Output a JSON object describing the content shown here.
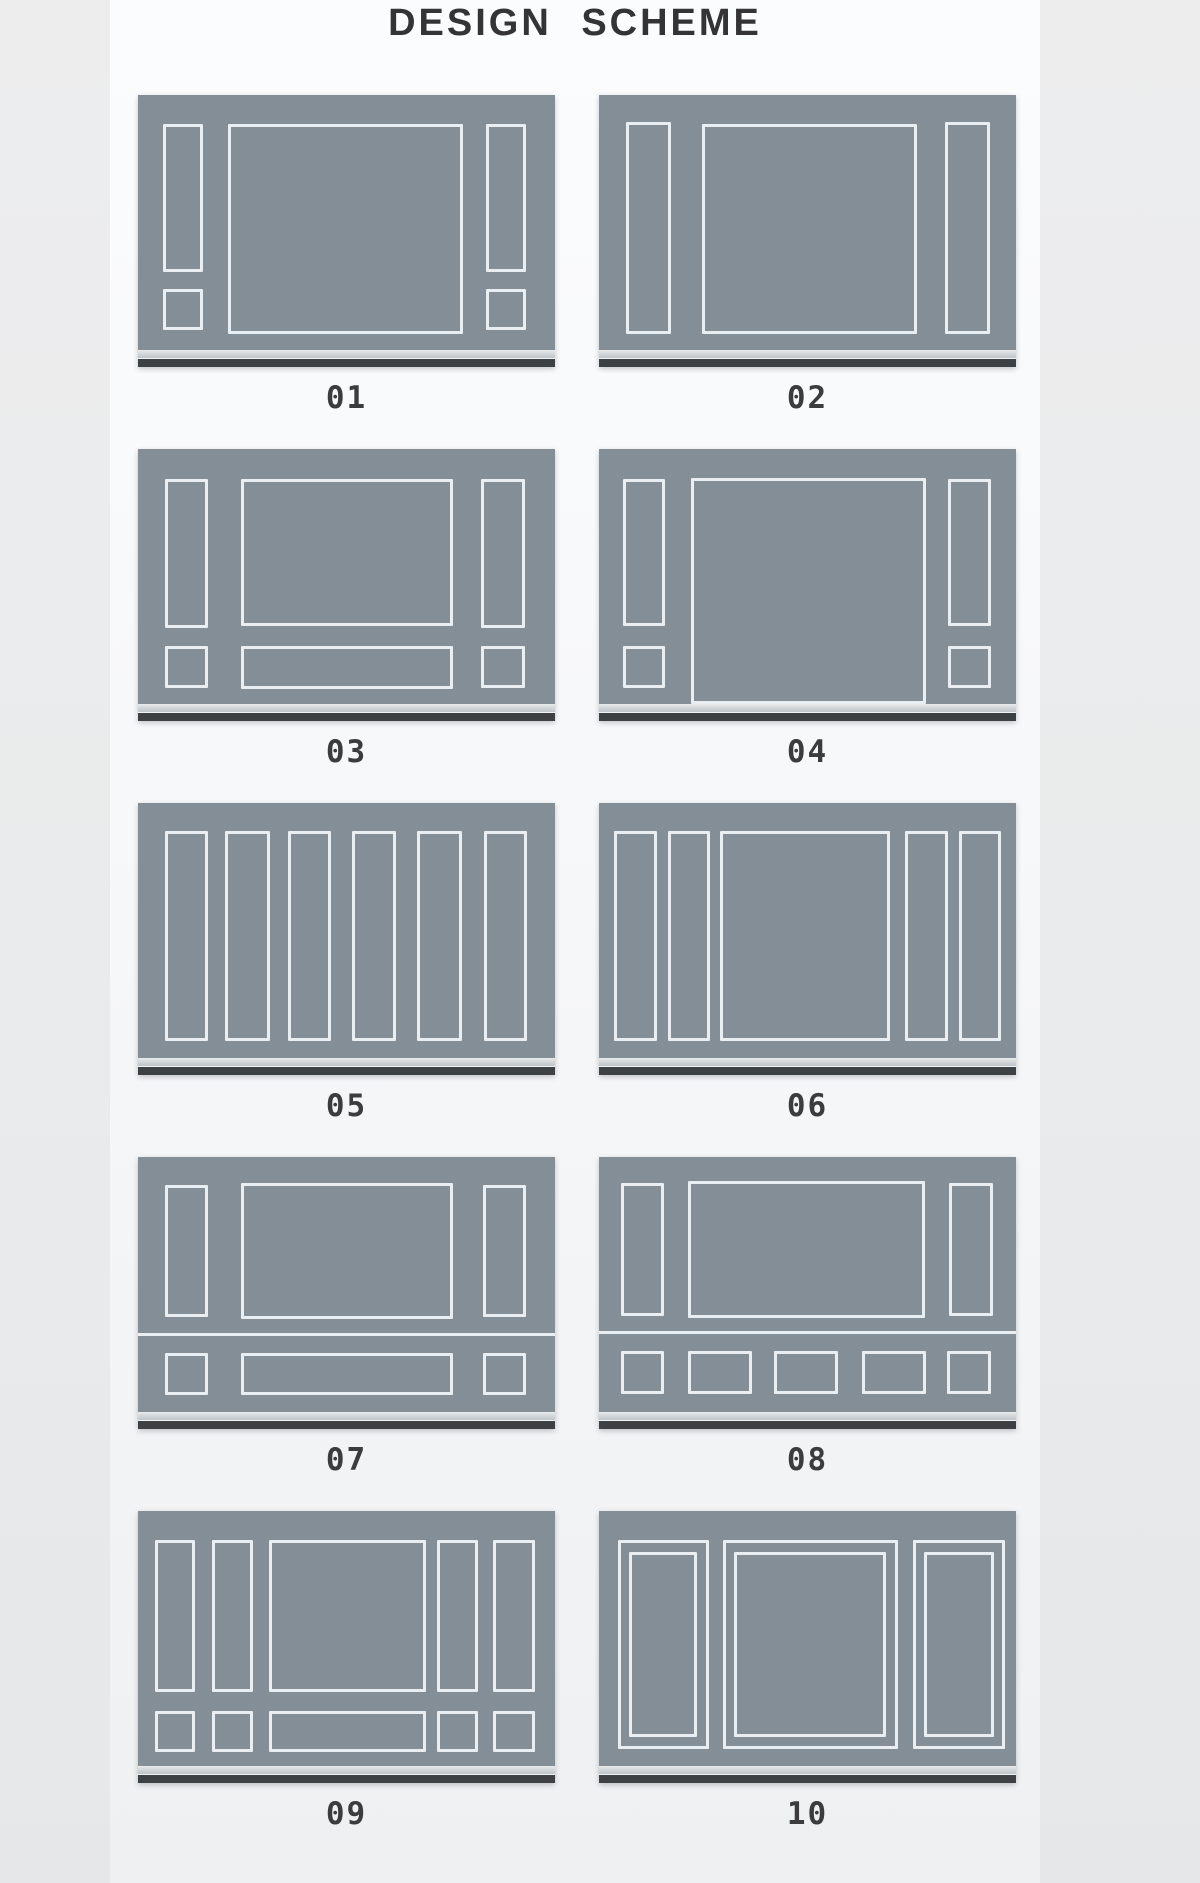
{
  "title": "DESIGN SCHEME",
  "colors": {
    "wall": "#848e97",
    "molding": "#e9eef2",
    "baseboard_dark": "#3e4144",
    "label": "#3c3c3e",
    "title": "#343436"
  },
  "schemes": [
    {
      "label": "01",
      "rects": [
        [
          6.0,
          11.4,
          9.6,
          58.0
        ],
        [
          6.0,
          76.0,
          9.6,
          16.0
        ],
        [
          21.6,
          11.4,
          56.4,
          82.3
        ],
        [
          83.5,
          11.4,
          9.6,
          58.0
        ],
        [
          83.5,
          76.0,
          9.6,
          16.0
        ]
      ],
      "rails": []
    },
    {
      "label": "02",
      "rects": [
        [
          6.5,
          10.6,
          10.8,
          83.0
        ],
        [
          24.8,
          11.4,
          51.4,
          82.3
        ],
        [
          82.9,
          10.6,
          10.8,
          83.0
        ]
      ],
      "rails": []
    },
    {
      "label": "03",
      "rects": [
        [
          6.5,
          11.8,
          10.3,
          58.4
        ],
        [
          6.5,
          77.3,
          10.3,
          16.5
        ],
        [
          24.7,
          11.8,
          50.8,
          57.6
        ],
        [
          24.7,
          77.3,
          50.8,
          16.9
        ],
        [
          82.3,
          11.8,
          10.6,
          58.4
        ],
        [
          82.3,
          77.3,
          10.6,
          16.5
        ]
      ],
      "rails": []
    },
    {
      "label": "04",
      "rects": [
        [
          5.8,
          11.8,
          10.1,
          57.6
        ],
        [
          5.8,
          77.3,
          10.1,
          16.5
        ],
        [
          22.0,
          11.4,
          56.3,
          88.6
        ],
        [
          83.6,
          11.8,
          10.4,
          57.6
        ],
        [
          83.6,
          77.3,
          10.4,
          16.5
        ]
      ],
      "rails": []
    },
    {
      "label": "05",
      "rects": [
        [
          6.4,
          11.0,
          10.4,
          82.4
        ],
        [
          20.8,
          11.0,
          10.8,
          82.4
        ],
        [
          36.0,
          11.0,
          10.3,
          82.4
        ],
        [
          51.2,
          11.0,
          10.6,
          82.4
        ],
        [
          66.8,
          11.0,
          10.8,
          82.4
        ],
        [
          82.9,
          11.0,
          10.3,
          82.4
        ]
      ],
      "rails": []
    },
    {
      "label": "06",
      "rects": [
        [
          3.6,
          11.0,
          10.2,
          82.4
        ],
        [
          16.5,
          11.0,
          10.2,
          82.4
        ],
        [
          29.0,
          11.0,
          40.7,
          82.4
        ],
        [
          73.4,
          11.0,
          10.2,
          82.4
        ],
        [
          86.4,
          11.0,
          10.0,
          82.4
        ]
      ],
      "rails": []
    },
    {
      "label": "07",
      "rects": [
        [
          6.5,
          11.0,
          10.3,
          51.8
        ],
        [
          24.7,
          10.2,
          50.8,
          53.3
        ],
        [
          82.7,
          11.0,
          10.4,
          51.8
        ],
        [
          6.5,
          76.9,
          10.3,
          16.5
        ],
        [
          24.7,
          76.9,
          50.8,
          16.5
        ],
        [
          82.7,
          76.9,
          10.4,
          16.5
        ]
      ],
      "rails": [
        69.2
      ]
    },
    {
      "label": "08",
      "rects": [
        [
          5.3,
          10.0,
          10.4,
          52.2
        ],
        [
          21.3,
          9.5,
          56.9,
          53.5
        ],
        [
          84.0,
          10.0,
          10.4,
          52.2
        ],
        [
          5.3,
          75.9,
          10.4,
          17.0
        ],
        [
          21.3,
          75.9,
          15.5,
          17.0
        ],
        [
          41.9,
          75.9,
          15.5,
          17.0
        ],
        [
          63.0,
          75.9,
          15.3,
          17.0
        ],
        [
          83.5,
          75.9,
          10.4,
          17.0
        ]
      ],
      "rails": [
        68.4
      ]
    },
    {
      "label": "09",
      "rects": [
        [
          4.1,
          11.4,
          9.6,
          59.4
        ],
        [
          17.7,
          11.4,
          9.8,
          59.4
        ],
        [
          31.5,
          11.4,
          37.5,
          59.4
        ],
        [
          71.6,
          11.4,
          10.0,
          59.4
        ],
        [
          85.2,
          11.4,
          10.0,
          59.4
        ],
        [
          4.1,
          78.3,
          9.6,
          16.1
        ],
        [
          17.7,
          78.3,
          9.8,
          16.1
        ],
        [
          31.5,
          78.3,
          37.5,
          16.1
        ],
        [
          71.6,
          78.3,
          10.0,
          16.1
        ],
        [
          85.2,
          78.3,
          10.0,
          16.1
        ]
      ],
      "rails": []
    },
    {
      "label": "10",
      "rects": [
        [
          4.5,
          11.2,
          21.8,
          82.2
        ],
        [
          7.2,
          16.2,
          16.4,
          72.6
        ],
        [
          29.7,
          11.2,
          42.1,
          82.2
        ],
        [
          32.3,
          16.2,
          36.5,
          72.6
        ],
        [
          75.4,
          11.2,
          22.0,
          82.2
        ],
        [
          78.0,
          16.2,
          16.7,
          72.6
        ]
      ],
      "rails": []
    }
  ]
}
